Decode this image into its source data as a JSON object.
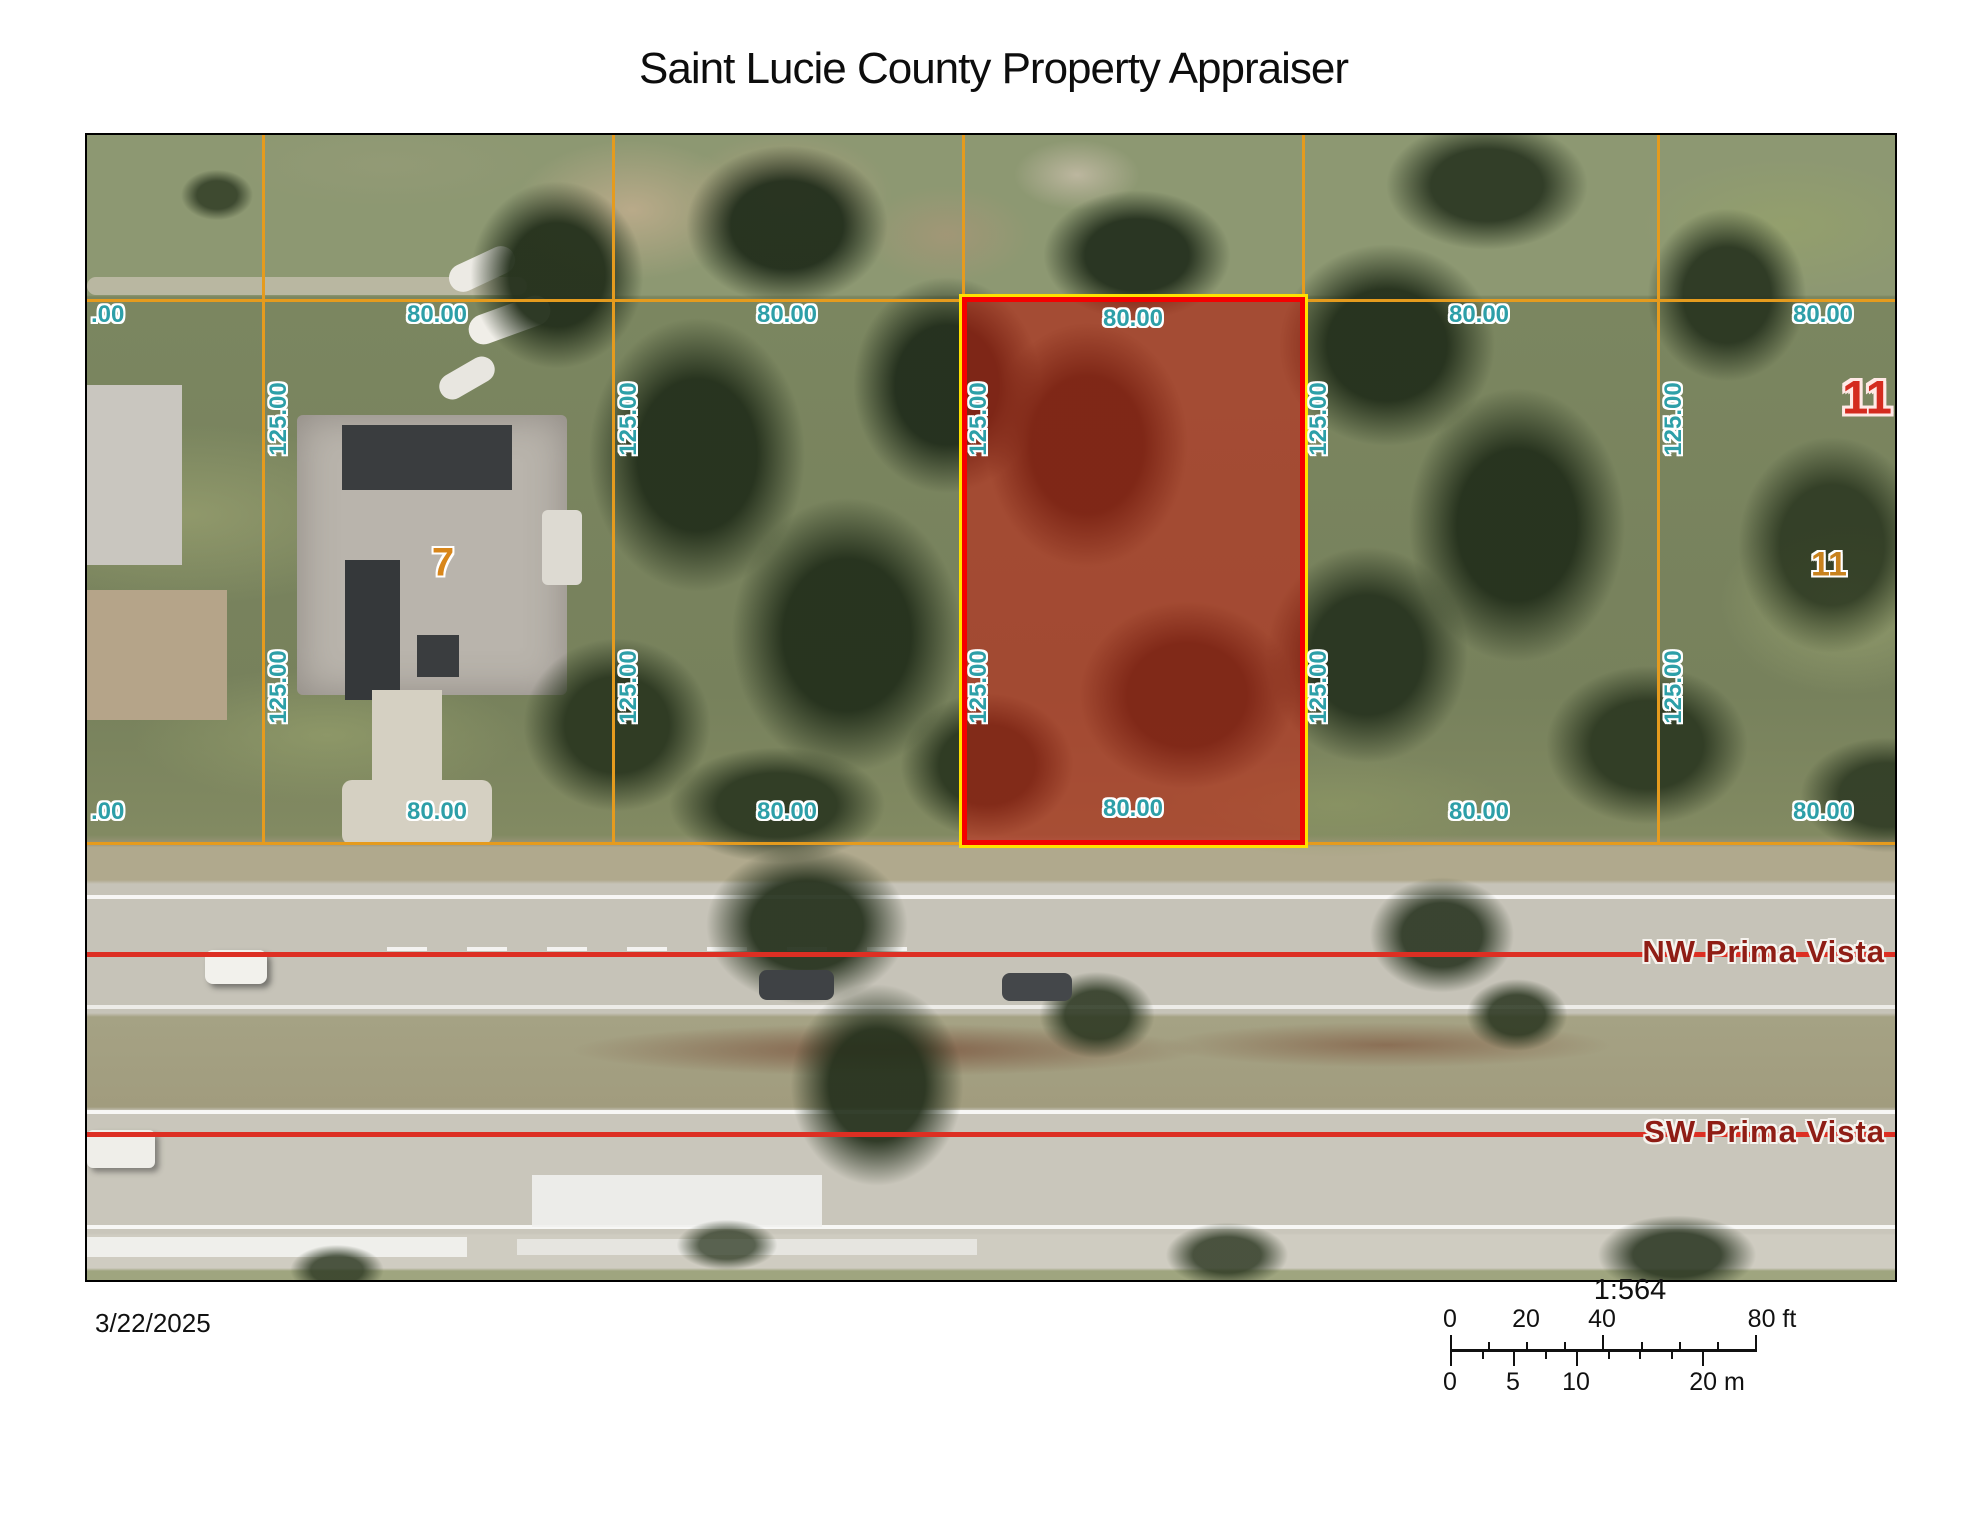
{
  "title": "Saint Lucie County Property Appraiser",
  "map": {
    "top_labels": [
      ".00",
      "80.00",
      "80.00",
      "80.00",
      "80.00",
      "80.00"
    ],
    "bottom_labels": [
      ".00",
      "80.00",
      "80.00",
      "80.00",
      "80.00",
      "80.00"
    ],
    "side_label": "125.00",
    "parcel_ids": {
      "house": "7",
      "block_red": "11",
      "block_orange": "11"
    },
    "streets": {
      "north": "NW Prima Vista",
      "south": "SW Prima Vista"
    }
  },
  "footer": {
    "date": "3/22/2025",
    "scale_ratio": "1:564",
    "feet_ticks": [
      "0",
      "20",
      "40",
      "80 ft"
    ],
    "meter_ticks": [
      "0",
      "5",
      "10",
      "20 m"
    ]
  },
  "colors": {
    "parcel_line": "#e59b1e",
    "dimension_text": "#2d9fa8",
    "highlight_fill": "rgba(198,30,16,0.55)",
    "highlight_border": "#f40000",
    "highlight_outline": "#ffe100",
    "street_line": "#dd2f23",
    "street_text": "#8f1d15",
    "parcel_id_orange": "#d8861a",
    "block_id_red": "#d42b1f"
  }
}
